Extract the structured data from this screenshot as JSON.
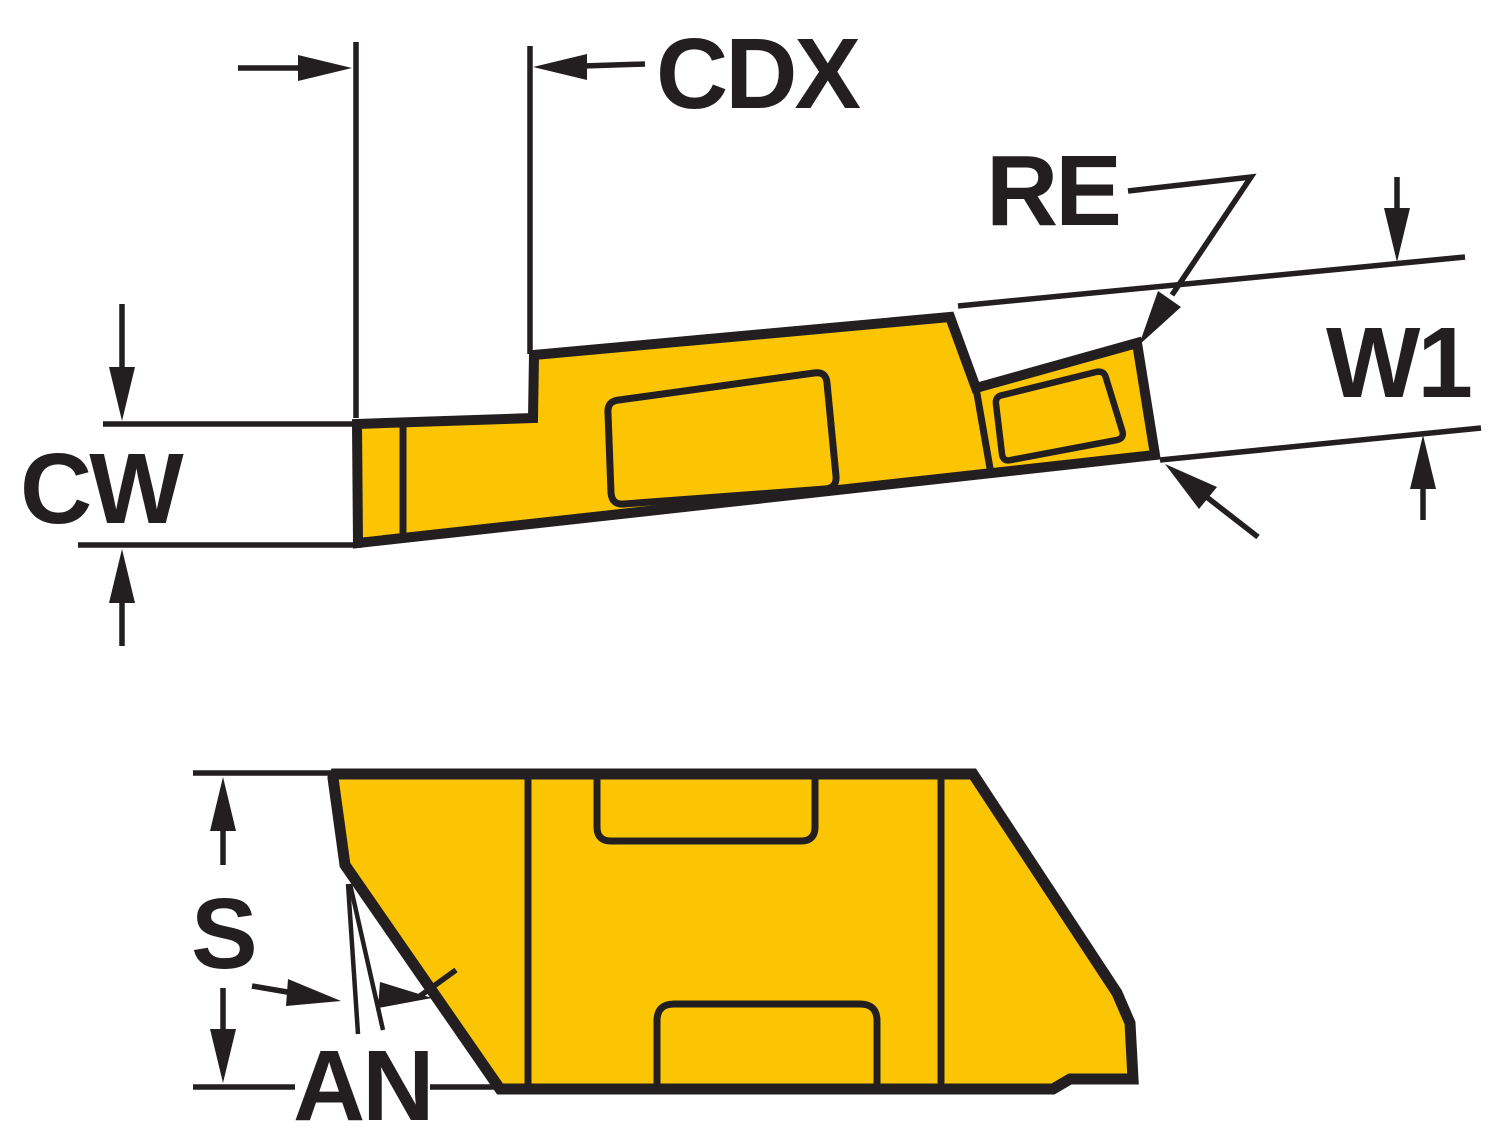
{
  "diagram": {
    "type": "technical-drawing",
    "labels": {
      "cdx": "CDX",
      "re": "RE",
      "w1": "W1",
      "cw": "CW",
      "s": "S",
      "an": "AN"
    },
    "colors": {
      "insert_fill": "#FBC504",
      "line": "#231F20",
      "background": "#FFFFFF"
    },
    "views": {
      "side_view": "insert-side-profile",
      "front_view": "insert-front-profile"
    }
  }
}
